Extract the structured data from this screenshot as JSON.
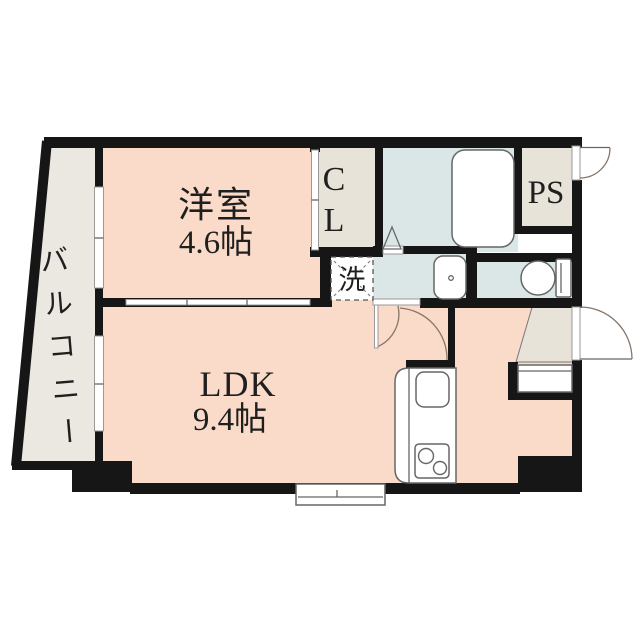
{
  "plan_title": "1LDK floor plan",
  "rooms": {
    "western_room": {
      "name": "洋室",
      "size": "4.6帖"
    },
    "ldk": {
      "name": "LDK",
      "size": "9.4帖"
    },
    "balcony": {
      "name": "バルコニー"
    },
    "closet": {
      "abbr": "CL",
      "line1": "C",
      "line2": "L"
    },
    "pipe_space": {
      "abbr": "PS"
    },
    "laundry": {
      "label": "洗"
    }
  },
  "colors": {
    "wall": "#161616",
    "room_pink": "#fadbc9",
    "wet_blue": "#dbe7e6",
    "service_beige": "#e7e3d8",
    "balcony_grey": "#eae8e0",
    "fixture_white": "#ffffff",
    "background": "#ffffff"
  }
}
